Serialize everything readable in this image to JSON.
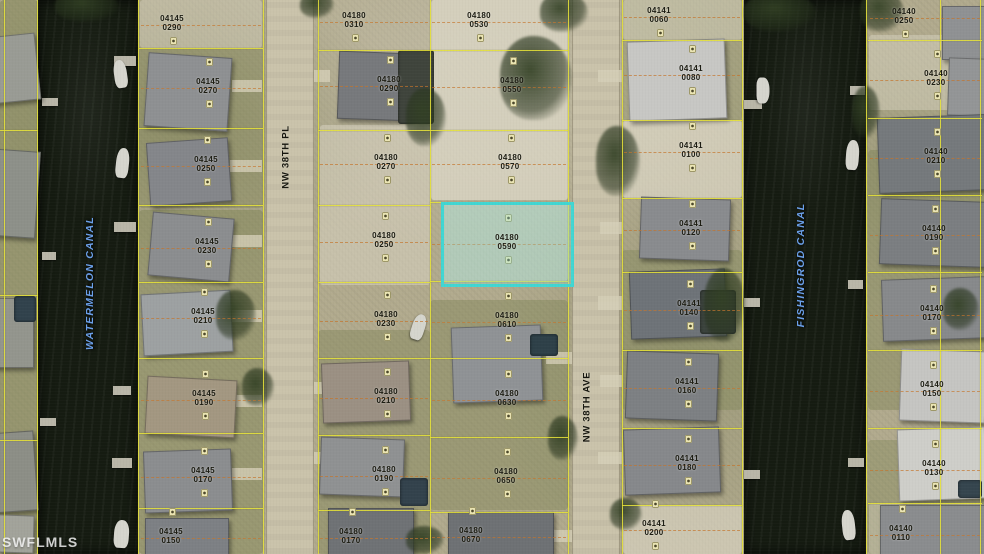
{
  "map": {
    "watermark": "SWFLMLS",
    "street_labels": [
      {
        "name": "NW 38TH PL",
        "x": 286,
        "y": 157
      },
      {
        "name": "NW 38TH AVE",
        "x": 587,
        "y": 407
      }
    ],
    "canal_labels": [
      {
        "name": "WATERMELON CANAL",
        "x": 90,
        "y": 283
      },
      {
        "name": "FISHINGROD CANAL",
        "x": 801,
        "y": 265
      }
    ],
    "highlighted_parcel": {
      "block": "04180",
      "lot": "0590",
      "x": 441,
      "y": 202,
      "w": 127,
      "h": 79
    },
    "colors": {
      "parcel_line": "#e6e238",
      "dashed_lot_line": "rgba(198,118,44,0.85)",
      "water": "#151b11",
      "road": "#cac3ab",
      "label_text": "#1c1c12",
      "street_text": "#15150d",
      "canal_text": "#6ba0ea",
      "highlight_border": "#41d6d2",
      "highlight_fill": "rgba(140,228,222,0.32)",
      "watermark_text": "rgba(255,255,255,0.8)"
    },
    "columns": {
      "cA": {
        "x": 0,
        "w": 38
      },
      "c1": {
        "x": 139,
        "w": 124
      },
      "c2": {
        "x": 318,
        "w": 112
      },
      "c3": {
        "x": 430,
        "w": 138
      },
      "c4": {
        "x": 622,
        "w": 120
      },
      "c5": {
        "x": 868,
        "w": 114
      }
    },
    "parcels": [
      {
        "block": "04145",
        "lot": "0290",
        "x": 152,
        "y": 15,
        "col": "c1"
      },
      {
        "block": "04145",
        "lot": "0270",
        "x": 188,
        "y": 78,
        "col": "c1"
      },
      {
        "block": "04145",
        "lot": "0250",
        "x": 186,
        "y": 156,
        "col": "c1"
      },
      {
        "block": "04145",
        "lot": "0230",
        "x": 187,
        "y": 238,
        "col": "c1"
      },
      {
        "block": "04145",
        "lot": "0210",
        "x": 183,
        "y": 308,
        "col": "c1"
      },
      {
        "block": "04145",
        "lot": "0190",
        "x": 184,
        "y": 390,
        "col": "c1"
      },
      {
        "block": "04145",
        "lot": "0170",
        "x": 183,
        "y": 467,
        "col": "c1"
      },
      {
        "block": "04145",
        "lot": "0150",
        "x": 151,
        "y": 528,
        "col": "c1"
      },
      {
        "block": "04180",
        "lot": "0310",
        "x": 334,
        "y": 12,
        "col": "c2"
      },
      {
        "block": "04180",
        "lot": "0290",
        "x": 369,
        "y": 76,
        "col": "c2"
      },
      {
        "block": "04180",
        "lot": "0270",
        "x": 366,
        "y": 154,
        "col": "c2"
      },
      {
        "block": "04180",
        "lot": "0250",
        "x": 364,
        "y": 232,
        "col": "c2"
      },
      {
        "block": "04180",
        "lot": "0230",
        "x": 366,
        "y": 311,
        "col": "c2"
      },
      {
        "block": "04180",
        "lot": "0210",
        "x": 366,
        "y": 388,
        "col": "c2"
      },
      {
        "block": "04180",
        "lot": "0190",
        "x": 364,
        "y": 466,
        "col": "c2"
      },
      {
        "block": "04180",
        "lot": "0170",
        "x": 331,
        "y": 528,
        "col": "c2"
      },
      {
        "block": "04180",
        "lot": "0530",
        "x": 459,
        "y": 12,
        "col": "c3"
      },
      {
        "block": "04180",
        "lot": "0550",
        "x": 492,
        "y": 77,
        "col": "c3"
      },
      {
        "block": "04180",
        "lot": "0570",
        "x": 490,
        "y": 154,
        "col": "c3"
      },
      {
        "block": "04180",
        "lot": "0590",
        "x": 487,
        "y": 234,
        "col": "c3"
      },
      {
        "block": "04180",
        "lot": "0610",
        "x": 487,
        "y": 312,
        "col": "c3"
      },
      {
        "block": "04180",
        "lot": "0630",
        "x": 487,
        "y": 390,
        "col": "c3"
      },
      {
        "block": "04180",
        "lot": "0650",
        "x": 486,
        "y": 468,
        "col": "c3"
      },
      {
        "block": "04180",
        "lot": "0670",
        "x": 451,
        "y": 527,
        "col": "c3"
      },
      {
        "block": "04141",
        "lot": "0060",
        "x": 639,
        "y": 7,
        "col": "c4"
      },
      {
        "block": "04141",
        "lot": "0080",
        "x": 671,
        "y": 65,
        "col": "c4"
      },
      {
        "block": "04141",
        "lot": "0100",
        "x": 671,
        "y": 142,
        "col": "c4"
      },
      {
        "block": "04141",
        "lot": "0120",
        "x": 671,
        "y": 220,
        "col": "c4"
      },
      {
        "block": "04141",
        "lot": "0140",
        "x": 669,
        "y": 300,
        "col": "c4"
      },
      {
        "block": "04141",
        "lot": "0160",
        "x": 667,
        "y": 378,
        "col": "c4"
      },
      {
        "block": "04141",
        "lot": "0180",
        "x": 667,
        "y": 455,
        "col": "c4"
      },
      {
        "block": "04141",
        "lot": "0200",
        "x": 634,
        "y": 520,
        "col": "c4"
      },
      {
        "block": "04140",
        "lot": "0250",
        "x": 884,
        "y": 8,
        "col": "c5"
      },
      {
        "block": "04140",
        "lot": "0230",
        "x": 916,
        "y": 70,
        "col": "c5"
      },
      {
        "block": "04140",
        "lot": "0210",
        "x": 916,
        "y": 148,
        "col": "c5"
      },
      {
        "block": "04140",
        "lot": "0190",
        "x": 914,
        "y": 225,
        "col": "c5"
      },
      {
        "block": "04140",
        "lot": "0170",
        "x": 912,
        "y": 305,
        "col": "c5"
      },
      {
        "block": "04140",
        "lot": "0150",
        "x": 912,
        "y": 381,
        "col": "c5"
      },
      {
        "block": "04140",
        "lot": "0130",
        "x": 914,
        "y": 460,
        "col": "c5"
      },
      {
        "block": "04140",
        "lot": "0110",
        "x": 881,
        "y": 525,
        "col": "c5"
      }
    ],
    "scene": {
      "water": [
        [
          38,
          0,
          100,
          554
        ],
        [
          744,
          0,
          122,
          554
        ]
      ],
      "roads": [
        [
          266,
          0,
          46,
          554
        ],
        [
          572,
          0,
          46,
          554
        ]
      ],
      "grass": [
        [
          0,
          0,
          38,
          554,
          0.5
        ],
        [
          139,
          210,
          124,
          344,
          0.45
        ],
        [
          139,
          48,
          124,
          160,
          0.32
        ],
        [
          318,
          330,
          112,
          224,
          0.4
        ],
        [
          430,
          300,
          138,
          210,
          0.4
        ],
        [
          622,
          250,
          120,
          160,
          0.35
        ],
        [
          622,
          0,
          120,
          120,
          0.28
        ],
        [
          868,
          150,
          116,
          260,
          0.4
        ],
        [
          868,
          440,
          116,
          114,
          0.35
        ]
      ],
      "sand": [
        [
          431,
          0,
          137,
          200,
          0.85
        ],
        [
          441,
          202,
          127,
          79,
          0.5
        ],
        [
          320,
          125,
          110,
          160,
          0.55
        ],
        [
          623,
          120,
          119,
          78,
          0.78
        ],
        [
          623,
          505,
          119,
          49,
          0.7
        ],
        [
          869,
          35,
          114,
          75,
          0.5
        ],
        [
          140,
          0,
          122,
          48,
          0.45
        ],
        [
          623,
          0,
          119,
          40,
          0.5
        ],
        [
          869,
          503,
          114,
          51,
          0.4
        ]
      ],
      "vlines": [
        [
          4,
          0,
          554
        ],
        [
          37,
          0,
          554
        ],
        [
          138,
          0,
          554
        ],
        [
          263,
          0,
          554
        ],
        [
          318,
          0,
          554
        ],
        [
          430,
          0,
          554
        ],
        [
          568,
          0,
          554
        ],
        [
          622,
          0,
          554
        ],
        [
          742,
          0,
          554
        ],
        [
          866,
          0,
          554
        ],
        [
          940,
          0,
          554
        ],
        [
          980,
          0,
          554
        ]
      ],
      "rowlines": [
        {
          "x": 0,
          "w": 38,
          "ys": [
            130,
            295,
            440
          ]
        },
        {
          "x": 139,
          "w": 124,
          "ys": [
            48,
            128,
            205,
            282,
            358,
            433,
            508
          ]
        },
        {
          "x": 318,
          "w": 112,
          "ys": [
            50,
            130,
            205,
            282,
            358,
            435,
            510
          ]
        },
        {
          "x": 430,
          "w": 138,
          "ys": [
            50,
            130,
            202,
            281,
            358,
            437,
            512
          ]
        },
        {
          "x": 622,
          "w": 120,
          "ys": [
            40,
            120,
            198,
            272,
            350,
            428,
            505
          ]
        },
        {
          "x": 868,
          "w": 114,
          "ys": [
            40,
            118,
            195,
            272,
            350,
            428,
            503
          ]
        }
      ],
      "houses": [
        [
          -12,
          35,
          48,
          65,
          -6,
          "#999b94"
        ],
        [
          -14,
          150,
          50,
          85,
          4,
          "#8d9089"
        ],
        [
          -10,
          298,
          42,
          68,
          0,
          "#93958d"
        ],
        [
          -12,
          432,
          46,
          78,
          -4,
          "#8c8e86"
        ],
        [
          -2,
          515,
          34,
          36,
          2,
          "#a2a39a"
        ],
        [
          146,
          55,
          82,
          72,
          4,
          "#8e9092"
        ],
        [
          148,
          140,
          80,
          62,
          -4,
          "#84868a"
        ],
        [
          150,
          215,
          80,
          62,
          5,
          "#8b8d8f"
        ],
        [
          142,
          292,
          88,
          60,
          -3,
          "#9da1a2"
        ],
        [
          146,
          378,
          88,
          56,
          3,
          "#a39781"
        ],
        [
          144,
          450,
          86,
          60,
          -2,
          "#8b8d8f"
        ],
        [
          145,
          518,
          82,
          36,
          0,
          "#7d8084"
        ],
        [
          338,
          52,
          72,
          66,
          2,
          "#77797c"
        ],
        [
          322,
          362,
          86,
          58,
          -2,
          "#9b9083"
        ],
        [
          320,
          438,
          82,
          56,
          2,
          "#8f9192"
        ],
        [
          328,
          508,
          84,
          46,
          0,
          "#6f7275"
        ],
        [
          452,
          326,
          88,
          74,
          -2,
          "#8f9295"
        ],
        [
          448,
          512,
          104,
          42,
          0,
          "#6e7174"
        ],
        [
          628,
          40,
          96,
          78,
          -2,
          "#c7c7c4"
        ],
        [
          640,
          198,
          88,
          60,
          2,
          "#898b8e"
        ],
        [
          630,
          270,
          94,
          66,
          -2,
          "#6e7378"
        ],
        [
          626,
          352,
          90,
          66,
          2,
          "#7d8083"
        ],
        [
          624,
          428,
          94,
          64,
          -2,
          "#86888b"
        ],
        [
          942,
          6,
          42,
          52,
          0,
          "#8f9193"
        ],
        [
          948,
          58,
          36,
          56,
          2,
          "#939596"
        ],
        [
          878,
          116,
          106,
          74,
          -2,
          "#75797c"
        ],
        [
          880,
          200,
          104,
          64,
          2,
          "#7b7e81"
        ],
        [
          882,
          278,
          102,
          60,
          -2,
          "#87898b"
        ],
        [
          900,
          350,
          84,
          70,
          2,
          "#c5c5c2"
        ],
        [
          898,
          428,
          86,
          70,
          -2,
          "#cecec9"
        ],
        [
          880,
          505,
          104,
          49,
          0,
          "#8a8c8e"
        ]
      ],
      "pools": [
        [
          398,
          50,
          36,
          74,
          "#3f443c"
        ],
        [
          400,
          478,
          28,
          28,
          "#33424c"
        ],
        [
          530,
          334,
          28,
          22,
          "#2e4048"
        ],
        [
          700,
          290,
          36,
          44,
          "#3c443e"
        ],
        [
          958,
          480,
          24,
          18,
          "#35454e"
        ],
        [
          14,
          296,
          22,
          26,
          "#31424c"
        ]
      ],
      "trees": [
        [
          55,
          -10,
          64,
          32
        ],
        [
          500,
          36,
          72,
          84
        ],
        [
          540,
          -8,
          48,
          40
        ],
        [
          406,
          88,
          40,
          58
        ],
        [
          596,
          126,
          44,
          70
        ],
        [
          704,
          268,
          42,
          74
        ],
        [
          216,
          290,
          40,
          50
        ],
        [
          242,
          368,
          32,
          38
        ],
        [
          406,
          526,
          38,
          28
        ],
        [
          548,
          416,
          30,
          44
        ],
        [
          744,
          -8,
          72,
          40
        ],
        [
          860,
          -10,
          44,
          42
        ],
        [
          852,
          86,
          28,
          52
        ],
        [
          943,
          288,
          36,
          42
        ],
        [
          610,
          498,
          32,
          32
        ],
        [
          300,
          -8,
          34,
          26
        ]
      ],
      "docks": [
        [
          114,
          56,
          22,
          10
        ],
        [
          114,
          222,
          22,
          10
        ],
        [
          113,
          386,
          18,
          9
        ],
        [
          112,
          458,
          20,
          10
        ],
        [
          42,
          98,
          16,
          8
        ],
        [
          42,
          252,
          14,
          8
        ],
        [
          40,
          418,
          16,
          8
        ],
        [
          744,
          100,
          18,
          9
        ],
        [
          744,
          298,
          16,
          9
        ],
        [
          744,
          470,
          16,
          9
        ],
        [
          850,
          86,
          15,
          9
        ],
        [
          848,
          280,
          15,
          9
        ],
        [
          848,
          458,
          16,
          9
        ]
      ],
      "boats": [
        [
          114,
          60,
          13,
          28,
          -8
        ],
        [
          116,
          148,
          13,
          30,
          6
        ],
        [
          114,
          520,
          15,
          28,
          4
        ],
        [
          750,
          84,
          26,
          13,
          90
        ],
        [
          846,
          140,
          13,
          30,
          4
        ],
        [
          842,
          510,
          13,
          30,
          -6
        ],
        [
          412,
          314,
          13,
          26,
          18
        ]
      ],
      "driveways": [
        [
          232,
          80,
          30,
          12
        ],
        [
          230,
          160,
          32,
          12
        ],
        [
          232,
          235,
          30,
          12
        ],
        [
          232,
          310,
          30,
          12
        ],
        [
          234,
          395,
          28,
          12
        ],
        [
          232,
          468,
          30,
          12
        ],
        [
          314,
          70,
          16,
          12
        ],
        [
          314,
          382,
          16,
          12
        ],
        [
          314,
          452,
          16,
          12
        ],
        [
          546,
          352,
          26,
          12
        ],
        [
          544,
          530,
          28,
          12
        ],
        [
          598,
          70,
          24,
          12
        ],
        [
          600,
          222,
          22,
          12
        ],
        [
          598,
          296,
          24,
          14
        ],
        [
          600,
          375,
          22,
          12
        ],
        [
          598,
          452,
          24,
          12
        ]
      ]
    }
  }
}
